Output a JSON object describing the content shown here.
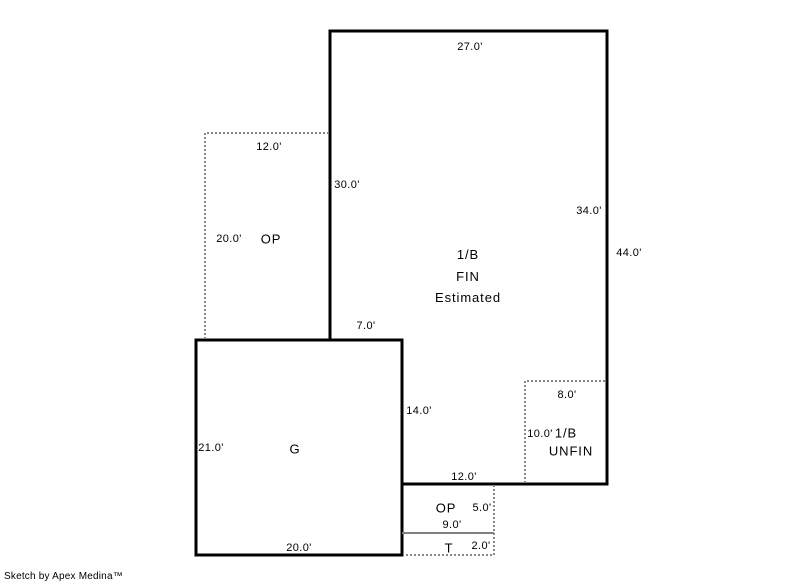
{
  "canvas": {
    "background": "#ffffff",
    "wall_color": "#000000",
    "dash_color": "#888888",
    "divider_color": "#808080"
  },
  "credit": "Sketch by Apex Medina™",
  "areas": {
    "main": {
      "line1": "1/B",
      "line2": "FIN",
      "line3": "Estimated"
    },
    "op_upper": {
      "label": "OP"
    },
    "garage": {
      "label": "G"
    },
    "basement_unfin": {
      "line1": "1/B",
      "line2": "UNFIN"
    },
    "op_lower": {
      "label": "OP"
    },
    "stoop": {
      "label": "T"
    }
  },
  "dimensions": {
    "main_top": "27.0'",
    "main_left": "30.0'",
    "main_right_inner": "34.0'",
    "main_right_outer": "44.0'",
    "main_step": "7.0'",
    "main_left_lower": "14.0'",
    "main_bottom": "12.0'",
    "op_upper_width": "12.0'",
    "op_upper_height": "20.0'",
    "garage_height": "21.0'",
    "garage_width": "20.0'",
    "unfin_width": "8.0'",
    "unfin_height": "10.0'",
    "op_lower_height": "5.0'",
    "op_lower_width": "9.0'",
    "stoop_height": "2.0'"
  }
}
